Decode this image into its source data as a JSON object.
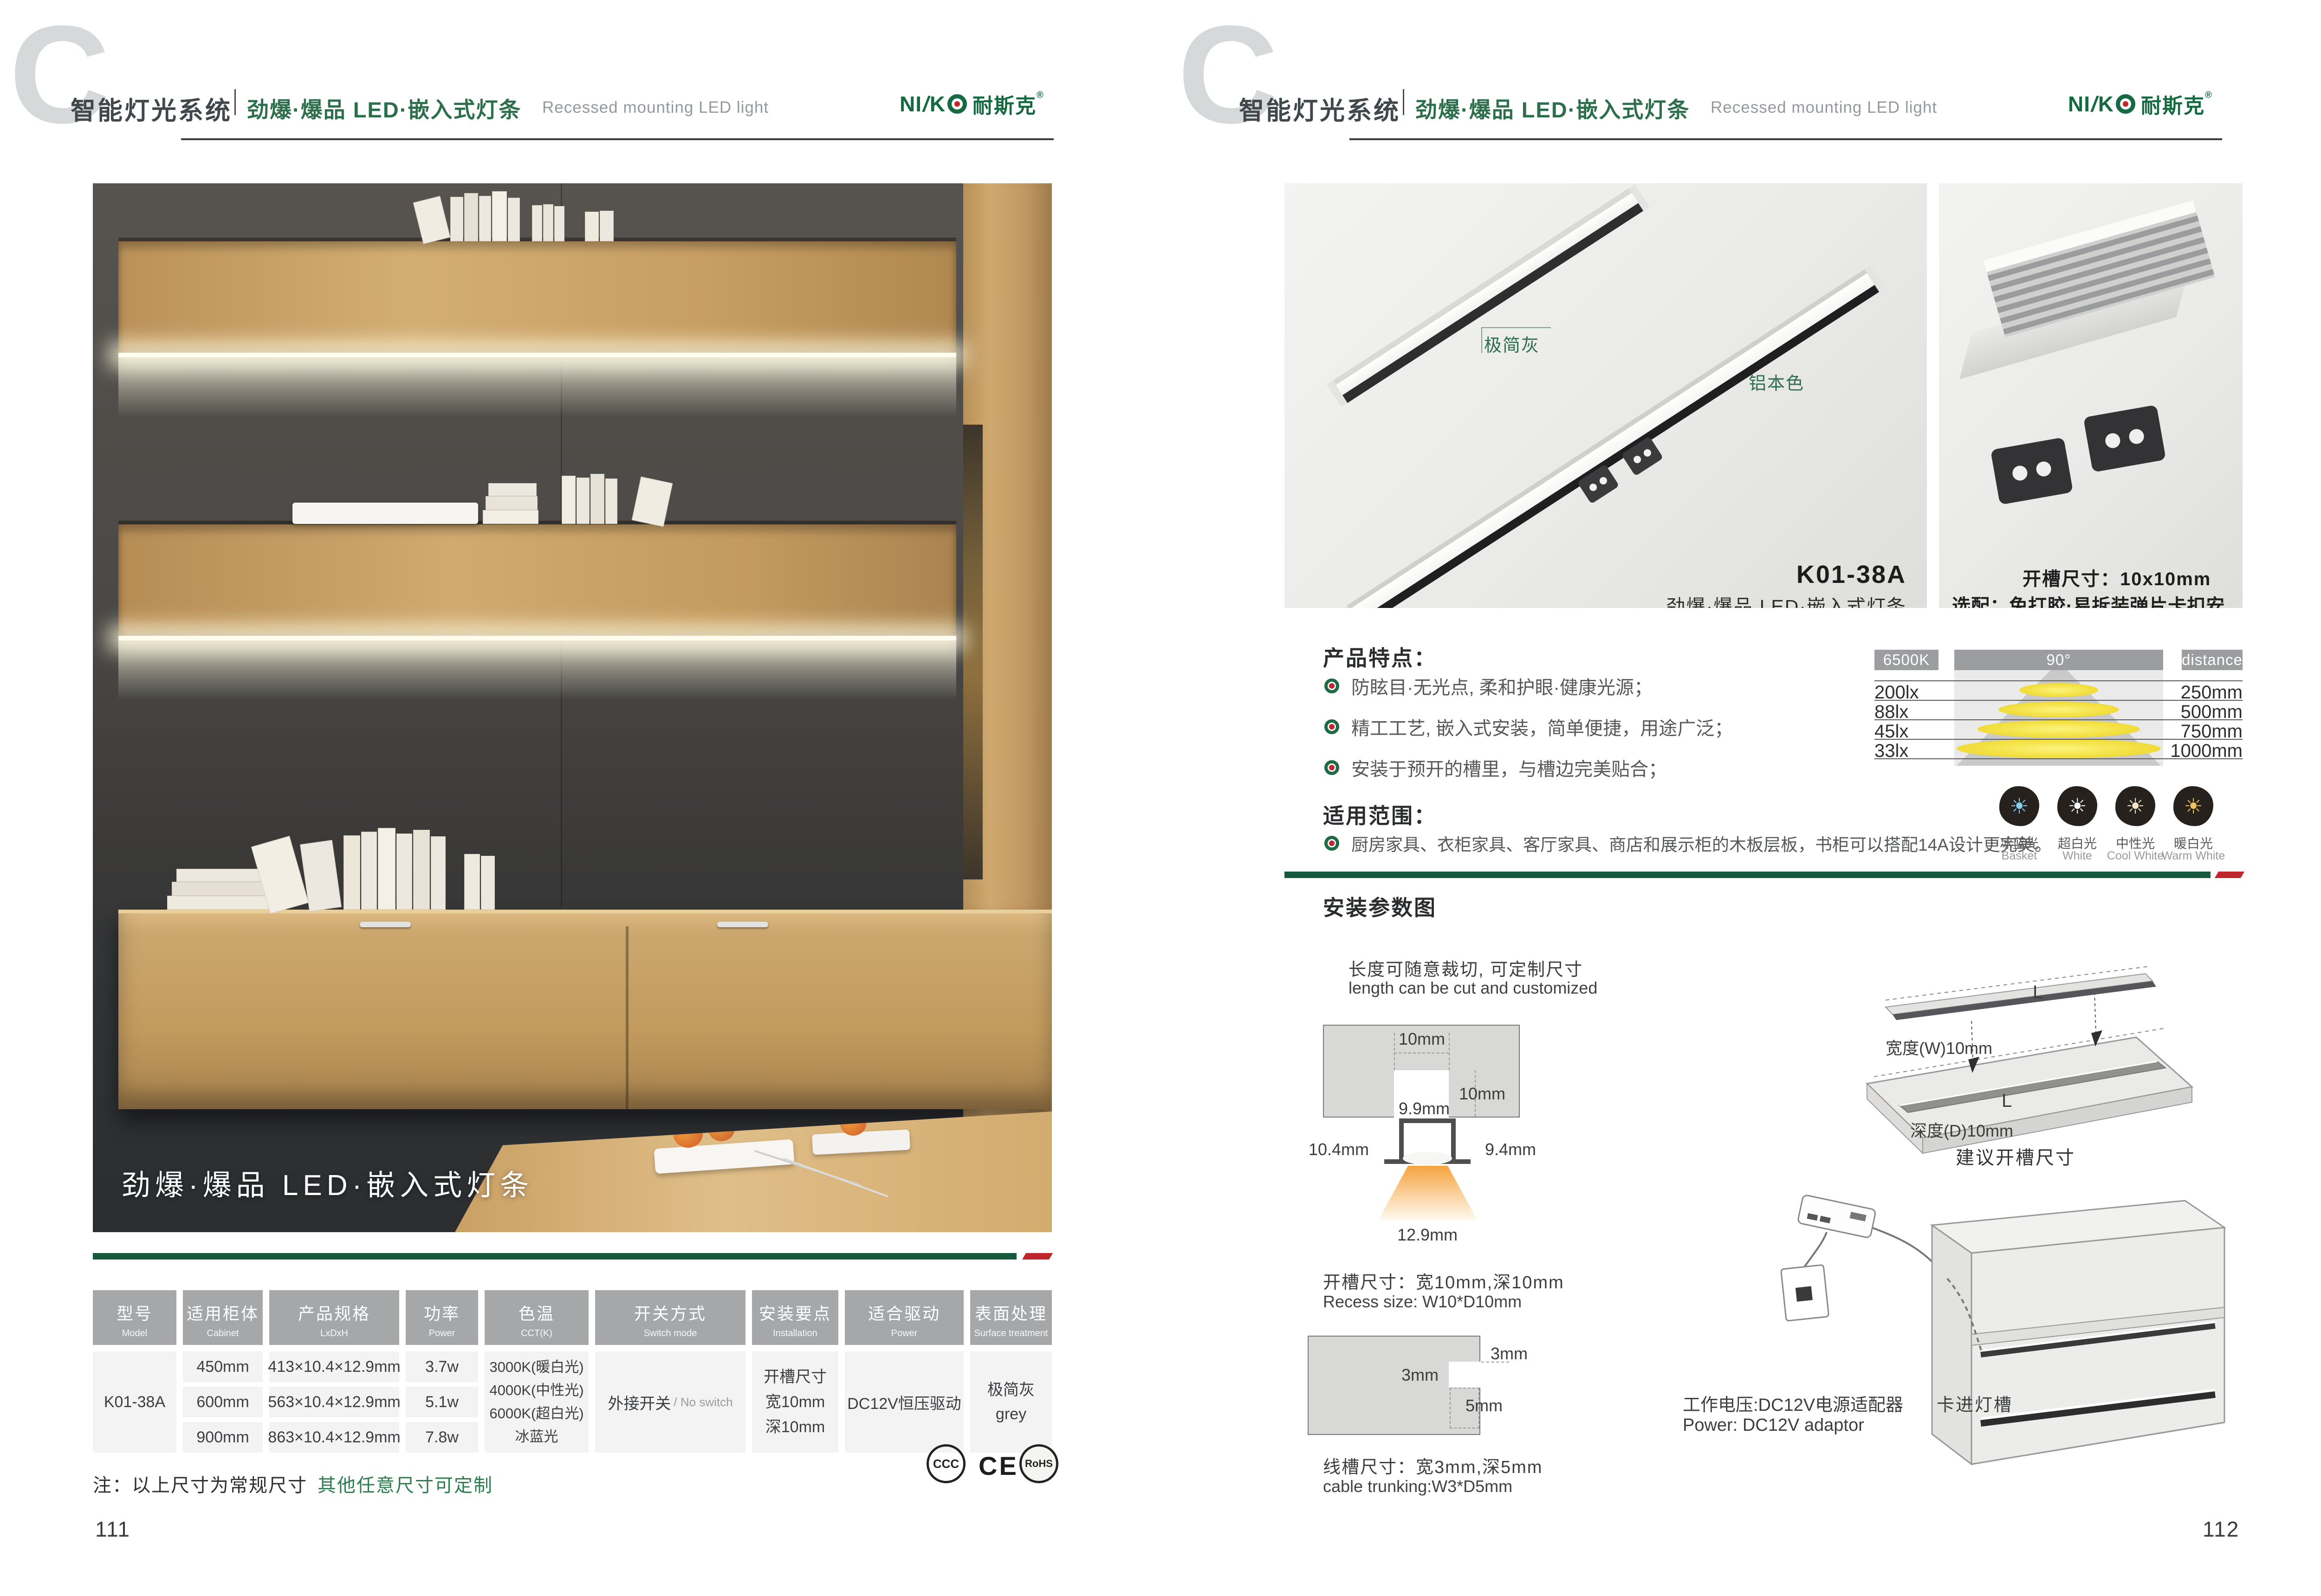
{
  "colors": {
    "brand_green": "#156a41",
    "title_green": "#2d6e4d",
    "bar_green": "#17593c",
    "bar_red": "#c0272d",
    "header_gray": "#a5a7a9",
    "text_dark": "#3f4649"
  },
  "header": {
    "c_mark": "C",
    "title_zh": "智能灯光系统",
    "subtitle_zh": "劲爆·爆品 LED·嵌入式灯条",
    "subtitle_en": "Recessed mounting LED light",
    "logo": {
      "p1": "NI",
      "p2": "/",
      "p3": "K",
      "cjk": "耐斯克",
      "reg": "®"
    }
  },
  "left_page": {
    "page_number": "111",
    "photo_caption": "劲爆·爆品 LED·嵌入式灯条",
    "note_black": "注：以上尺寸为常规尺寸",
    "note_green": "其他任意尺寸可定制",
    "certs": {
      "ccc": "CCC",
      "ce": "CE",
      "rohs": "RoHS"
    },
    "table": {
      "columns": [
        {
          "zh": "型号",
          "en": "Model"
        },
        {
          "zh": "适用柜体",
          "en": "Cabinet"
        },
        {
          "zh": "产品规格",
          "en": "LxDxH"
        },
        {
          "zh": "功率",
          "en": "Power"
        },
        {
          "zh": "色温",
          "en": "CCT(K)"
        },
        {
          "zh": "开关方式",
          "en": "Switch mode"
        },
        {
          "zh": "安装要点",
          "en": "Installation"
        },
        {
          "zh": "适合驱动",
          "en": "Power"
        },
        {
          "zh": "表面处理",
          "en": "Surface treatment"
        }
      ],
      "model": "K01-38A",
      "rows": [
        {
          "cabinet": "450mm",
          "spec": "413×10.4×12.9mm",
          "power": "3.7w"
        },
        {
          "cabinet": "600mm",
          "spec": "563×10.4×12.9mm",
          "power": "5.1w"
        },
        {
          "cabinet": "900mm",
          "spec": "863×10.4×12.9mm",
          "power": "7.8w"
        }
      ],
      "cct": [
        "3000K(暖白光)",
        "4000K(中性光)",
        "6000K(超白光)",
        "冰蓝光"
      ],
      "switch_zh": "外接开关",
      "switch_en": "/ No switch",
      "install": [
        "开槽尺寸",
        "宽10mm",
        "深10mm"
      ],
      "driver": "DC12V恒压驱动",
      "surface_zh": "极简灰",
      "surface_en": "grey"
    }
  },
  "right_page": {
    "page_number": "112",
    "label_gray": "极简灰",
    "label_aluminum": "铝本色",
    "product_code": "K01-38A",
    "product_desc": "劲爆·爆品 LED·嵌入式灯条",
    "opt_line1": "开槽尺寸：10x10mm",
    "opt_line2": "选配：免打胶·易拆装弹片卡扣安装",
    "features_title": "产品特点：",
    "features": [
      "防眩目·无光点, 柔和护眼·健康光源；",
      "精工工艺, 嵌入式安装，简单便捷，用途广泛；",
      "安装于预开的槽里，与槽边完美贴合；"
    ],
    "scope_title": "适用范围：",
    "scope_text": "厨房家具、衣柜家具、客厅家具、商店和展示柜的木板层板，书柜可以搭配14A设计更完美。",
    "light_chart": {
      "type": "table",
      "kelvin": "6500K",
      "angle": "90°",
      "distance_label": "distance",
      "rows": [
        {
          "lux": "200lx",
          "mm": "250mm"
        },
        {
          "lux": "88lx",
          "mm": "500mm"
        },
        {
          "lux": "45lx",
          "mm": "750mm"
        },
        {
          "lux": "33lx",
          "mm": "1000mm"
        }
      ]
    },
    "cct_icons": [
      {
        "zh": "冰蓝光",
        "en": "Basket",
        "color": "#86cdee"
      },
      {
        "zh": "超白光",
        "en": "White",
        "color": "#ffffff"
      },
      {
        "zh": "中性光",
        "en": "Cool White",
        "color": "#f1e6c8"
      },
      {
        "zh": "暖白光",
        "en": "Warm White",
        "color": "#eec05f"
      }
    ],
    "install_title": "安装参数图",
    "cut_zh": "长度可随意裁切, 可定制尺寸",
    "cut_en": "length can be cut and customized",
    "cross": {
      "top": "10mm",
      "side": "10mm",
      "inner": "9.9mm",
      "left": "10.4mm",
      "right": "9.4mm",
      "bottom": "12.9mm"
    },
    "recess_zh": "开槽尺寸：宽10mm,深10mm",
    "recess_en": "Recess size: W10*D10mm",
    "notch": {
      "r": "3mm",
      "l": "3mm",
      "d": "5mm"
    },
    "trunk_zh": "线槽尺寸：宽3mm,深5mm",
    "trunk_en": "cable trunking:W3*D5mm",
    "board": {
      "l_top": "L",
      "width": "宽度(W)10mm",
      "l_groove": "L",
      "depth": "深度(D)10mm",
      "caption": "建议开槽尺寸"
    },
    "power_zh": "工作电压:DC12V电源适配器",
    "power_en": "Power: DC12V adaptor",
    "slot_label": "卡进灯槽"
  }
}
